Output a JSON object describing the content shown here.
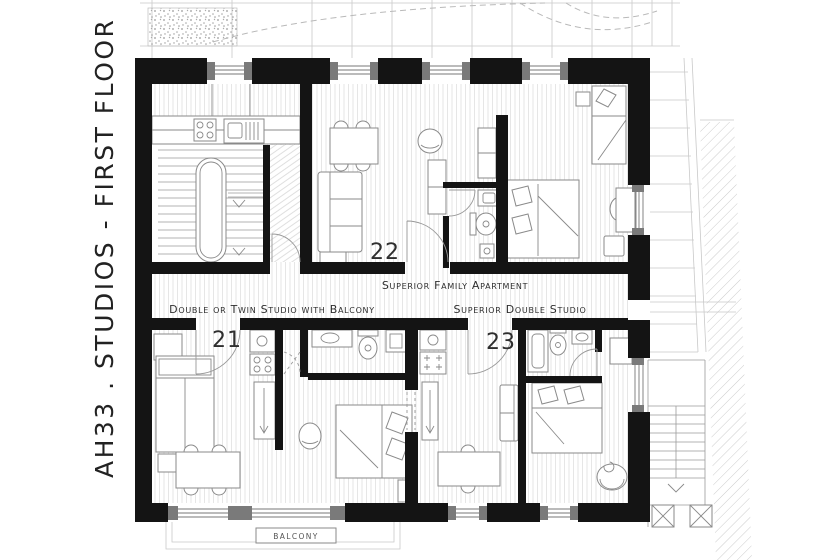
{
  "title": {
    "text": "AH33 . STUDIOS - FIRST FLOOR"
  },
  "units": [
    {
      "number": "22",
      "name": "Superior Family Apartment"
    },
    {
      "number": "21",
      "name": "Double or Twin Studio with Balcony"
    },
    {
      "number": "23",
      "name": "Superior Double Studio"
    }
  ],
  "labels": {
    "balcony": "BALCONY"
  },
  "colors": {
    "wall": "#141414",
    "furniture_line": "#8a8a8a",
    "floor_stripe": "#e4e4e4",
    "site_line": "#c9c9c9",
    "window_block": "#7a7a7a",
    "text": "#2e2e2e",
    "paper": "#ffffff"
  }
}
